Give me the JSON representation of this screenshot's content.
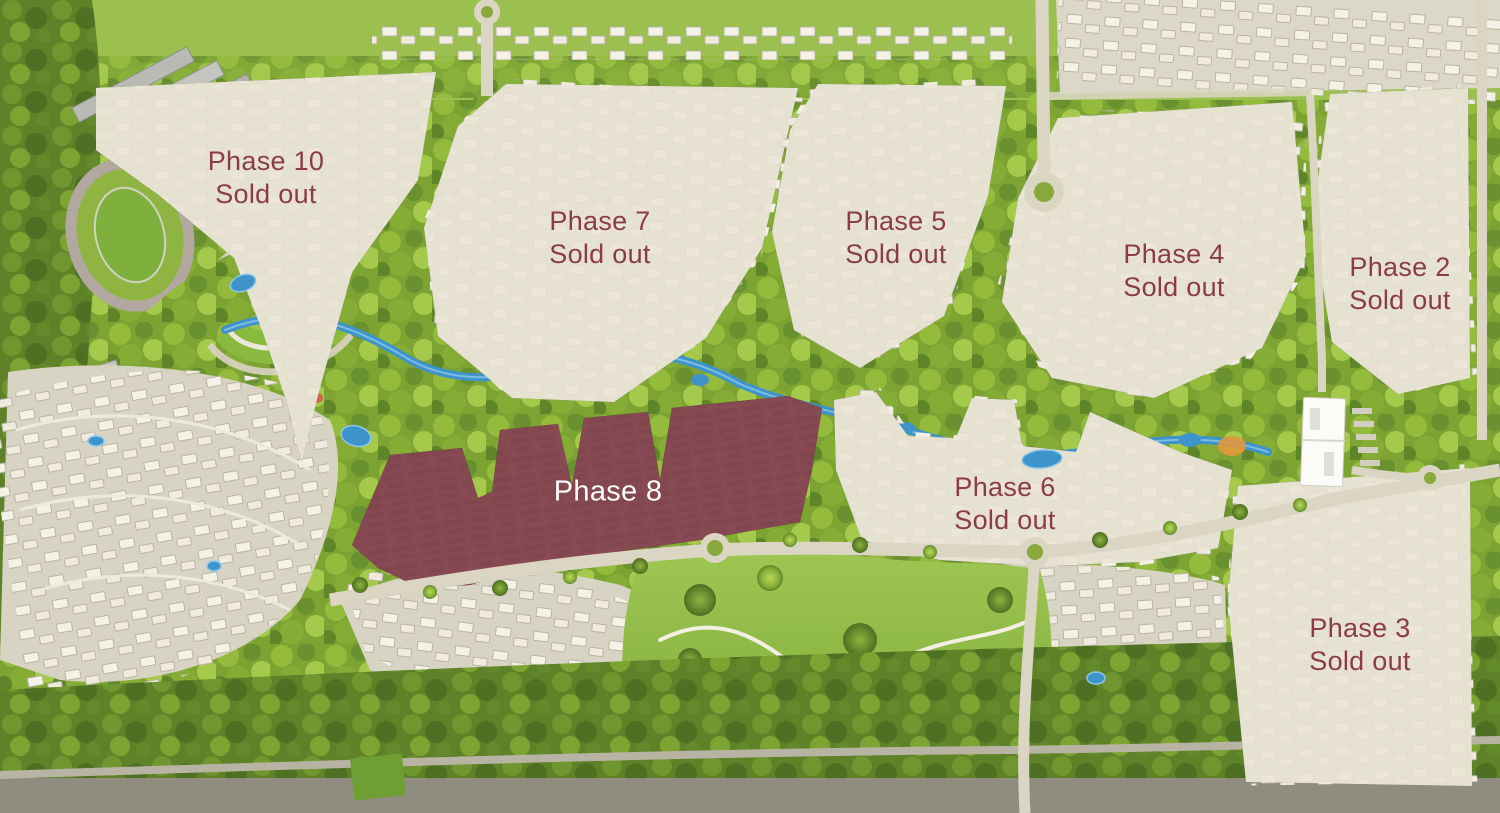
{
  "map": {
    "title": "Community masterplan aerial render with phase availability",
    "colors": {
      "highlight_phase_fill": "#8E4E56",
      "soldout_overlay_fill": "#E9E4D4",
      "label_text_maroon": "#8B3B4B",
      "label_text_white": "#FFFFFF",
      "water_blue": "#3F93CB",
      "canopy_green": "#7DA433",
      "road_gray": "#DBD6C4"
    },
    "phases": [
      {
        "id": "phase-10",
        "name": "Phase 10",
        "status": "Sold out",
        "state": "sold-out"
      },
      {
        "id": "phase-7",
        "name": "Phase 7",
        "status": "Sold out",
        "state": "sold-out"
      },
      {
        "id": "phase-5",
        "name": "Phase 5",
        "status": "Sold out",
        "state": "sold-out"
      },
      {
        "id": "phase-4",
        "name": "Phase 4",
        "status": "Sold out",
        "state": "sold-out"
      },
      {
        "id": "phase-2",
        "name": "Phase 2",
        "status": "Sold out",
        "state": "sold-out"
      },
      {
        "id": "phase-8",
        "name": "Phase 8",
        "status": "",
        "state": "highlighted"
      },
      {
        "id": "phase-6",
        "name": "Phase 6",
        "status": "Sold out",
        "state": "sold-out"
      },
      {
        "id": "phase-3",
        "name": "Phase 3",
        "status": "Sold out",
        "state": "sold-out"
      }
    ]
  }
}
